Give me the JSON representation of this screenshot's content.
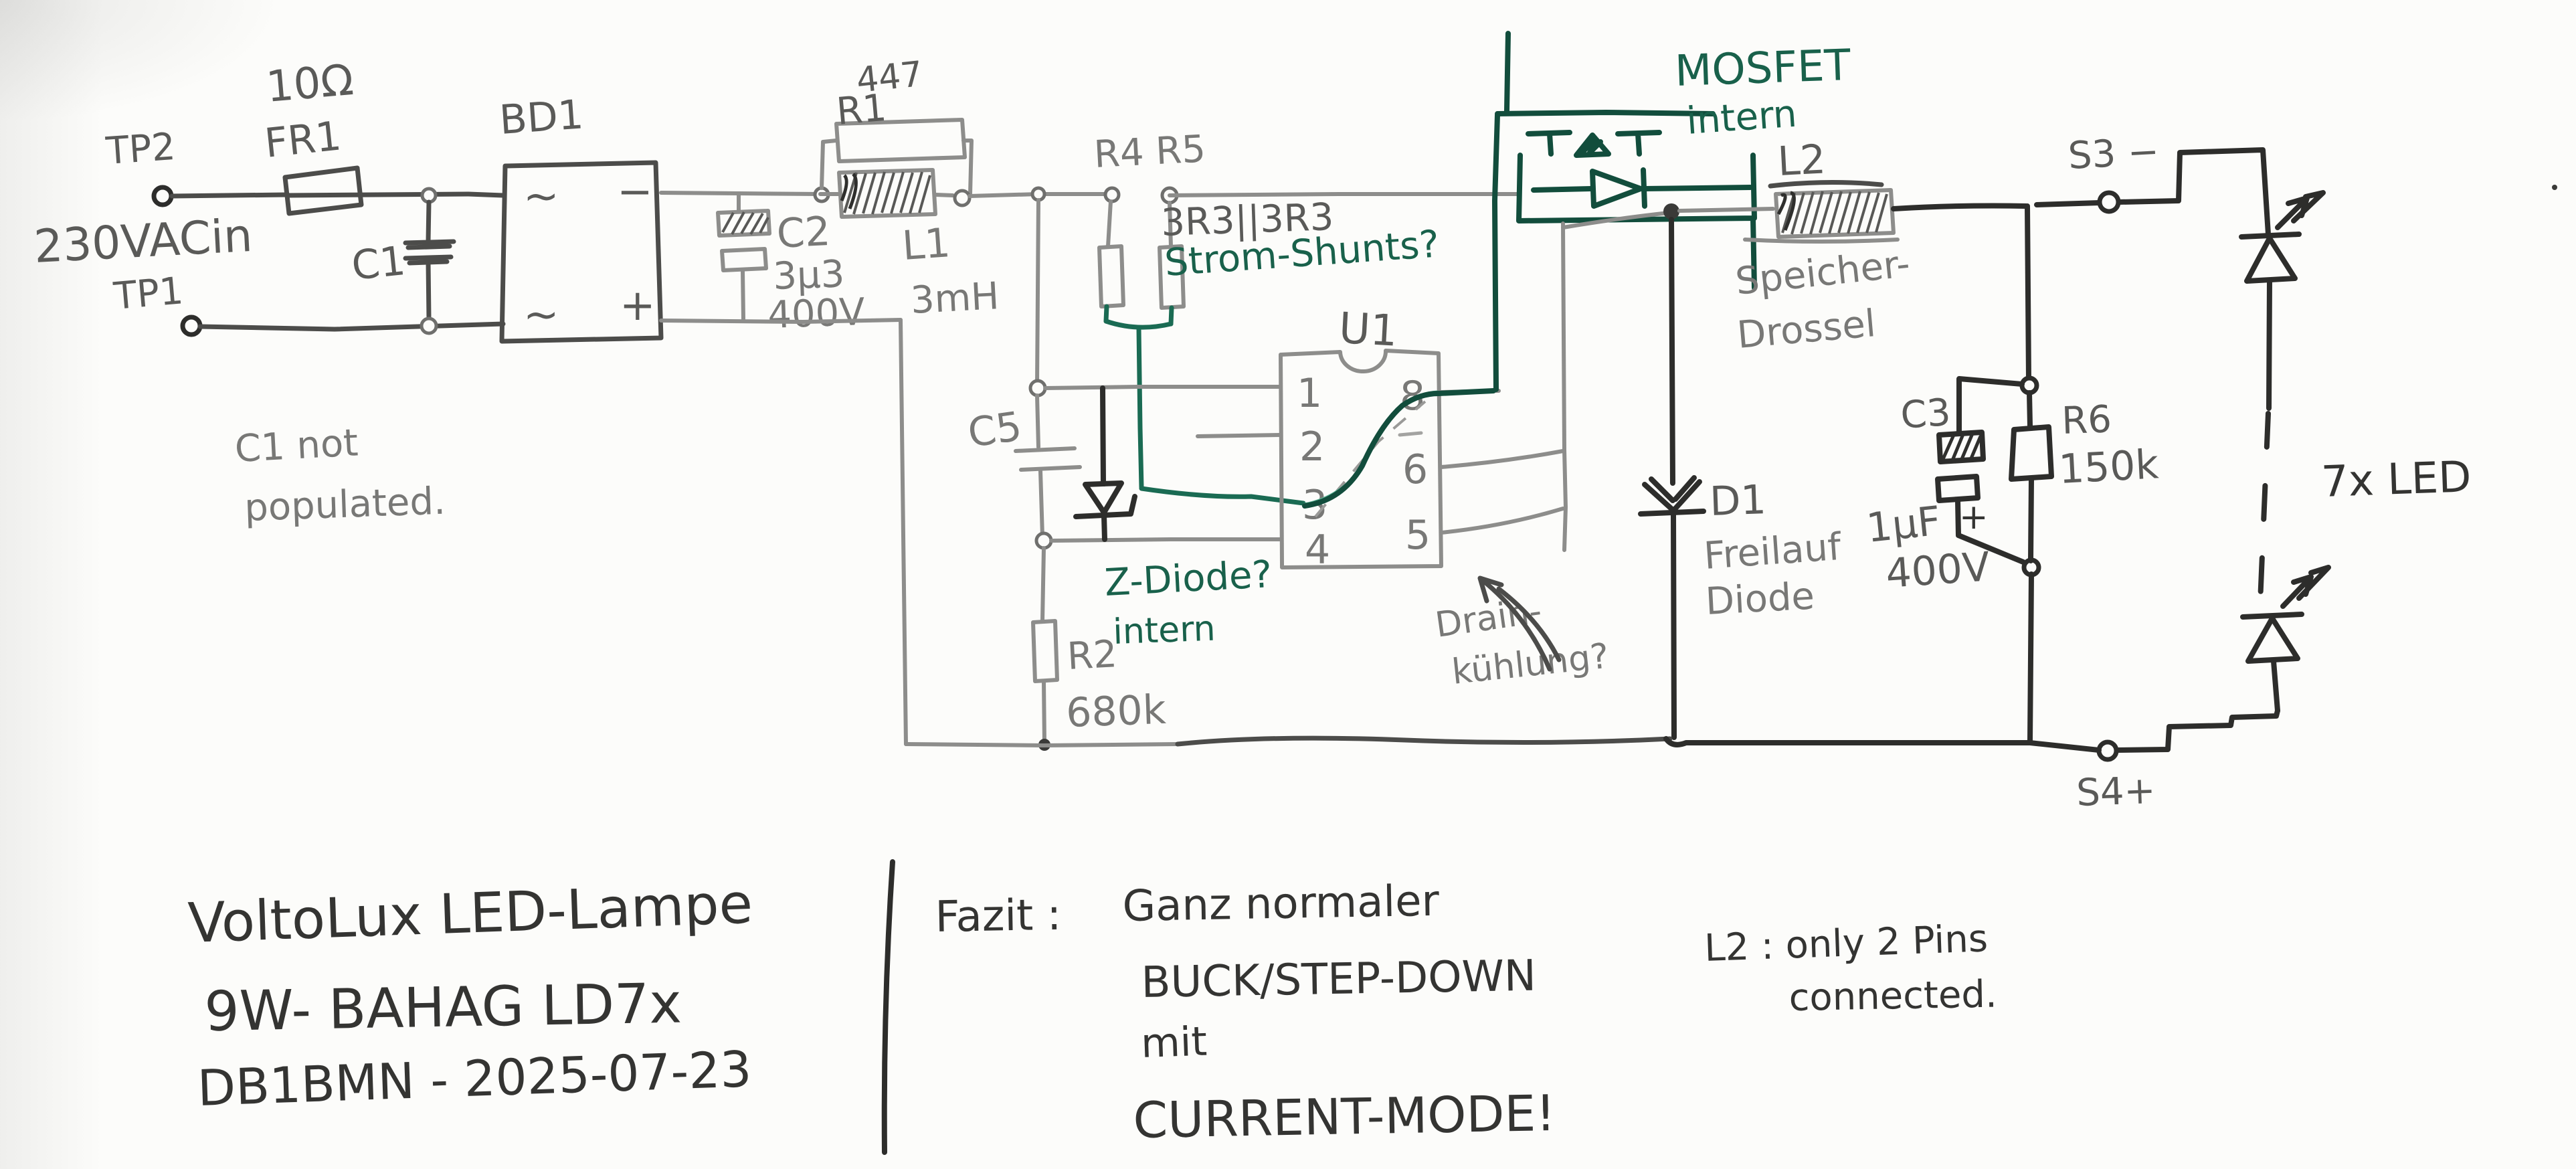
{
  "schematic": {
    "input": {
      "tp2": "TP2",
      "tp1": "TP1",
      "source": "230VACin",
      "fuse_value": "10Ω",
      "fuse_ref": "FR1",
      "c1_ref": "C1",
      "c1_note_line1": "C1 not",
      "c1_note_line2": "populated.",
      "bridge_ref": "BD1",
      "bridge_ac_top": "~",
      "bridge_ac_bottom": "~",
      "bridge_minus": "−",
      "bridge_plus": "+"
    },
    "filter": {
      "c2_ref": "C2",
      "c2_value": "3μ3",
      "c2_voltage": "400V",
      "r1_ref": "R1",
      "r1_value": "447",
      "l1_ref": "L1",
      "l1_value": "3mH"
    },
    "shunts": {
      "refs": "R4 R5",
      "value": "3R3||3R3",
      "note": "Strom-Shunts?"
    },
    "controller": {
      "ref": "U1",
      "pin1": "1",
      "pin2": "2",
      "pin3": "3",
      "pin4": "4",
      "pin5": "5",
      "pin6": "6",
      "pin8": "8",
      "c5_ref": "C5",
      "r2_ref": "R2",
      "r2_value": "680k",
      "zdiode_line1": "Z-Diode?",
      "zdiode_line2": "intern",
      "drain_line1": "Drain-",
      "drain_line2": "kühlung?"
    },
    "mosfet": {
      "note_line1": "MOSFET",
      "note_line2": "intern"
    },
    "output": {
      "l2_ref": "L2",
      "l2_line1": "Speicher-",
      "l2_line2": "Drossel",
      "d1_ref": "D1",
      "d1_line1": "Freilauf",
      "d1_line2": "Diode",
      "c3_ref": "C3",
      "c3_value": "1μF",
      "c3_voltage": "400V",
      "c3_plus": "+",
      "r6_ref": "R6",
      "r6_value": "150k",
      "s3": "S3 −",
      "s4": "S4+",
      "led_count": "7x LED"
    }
  },
  "notes": {
    "title_line1": "VoltoLux LED-Lampe",
    "title_line2": "9W- BAHAG LD7x",
    "title_line3": "DB1BMN - 2025-07-23",
    "fazit_label": "Fazit :",
    "fazit_line1": "Ganz normaler",
    "fazit_line2": "BUCK/STEP-DOWN",
    "fazit_line3": "mit",
    "fazit_line4": "CURRENT-MODE!",
    "l2_note_line1": "L2 : only 2 Pins",
    "l2_note_line2": "connected."
  }
}
